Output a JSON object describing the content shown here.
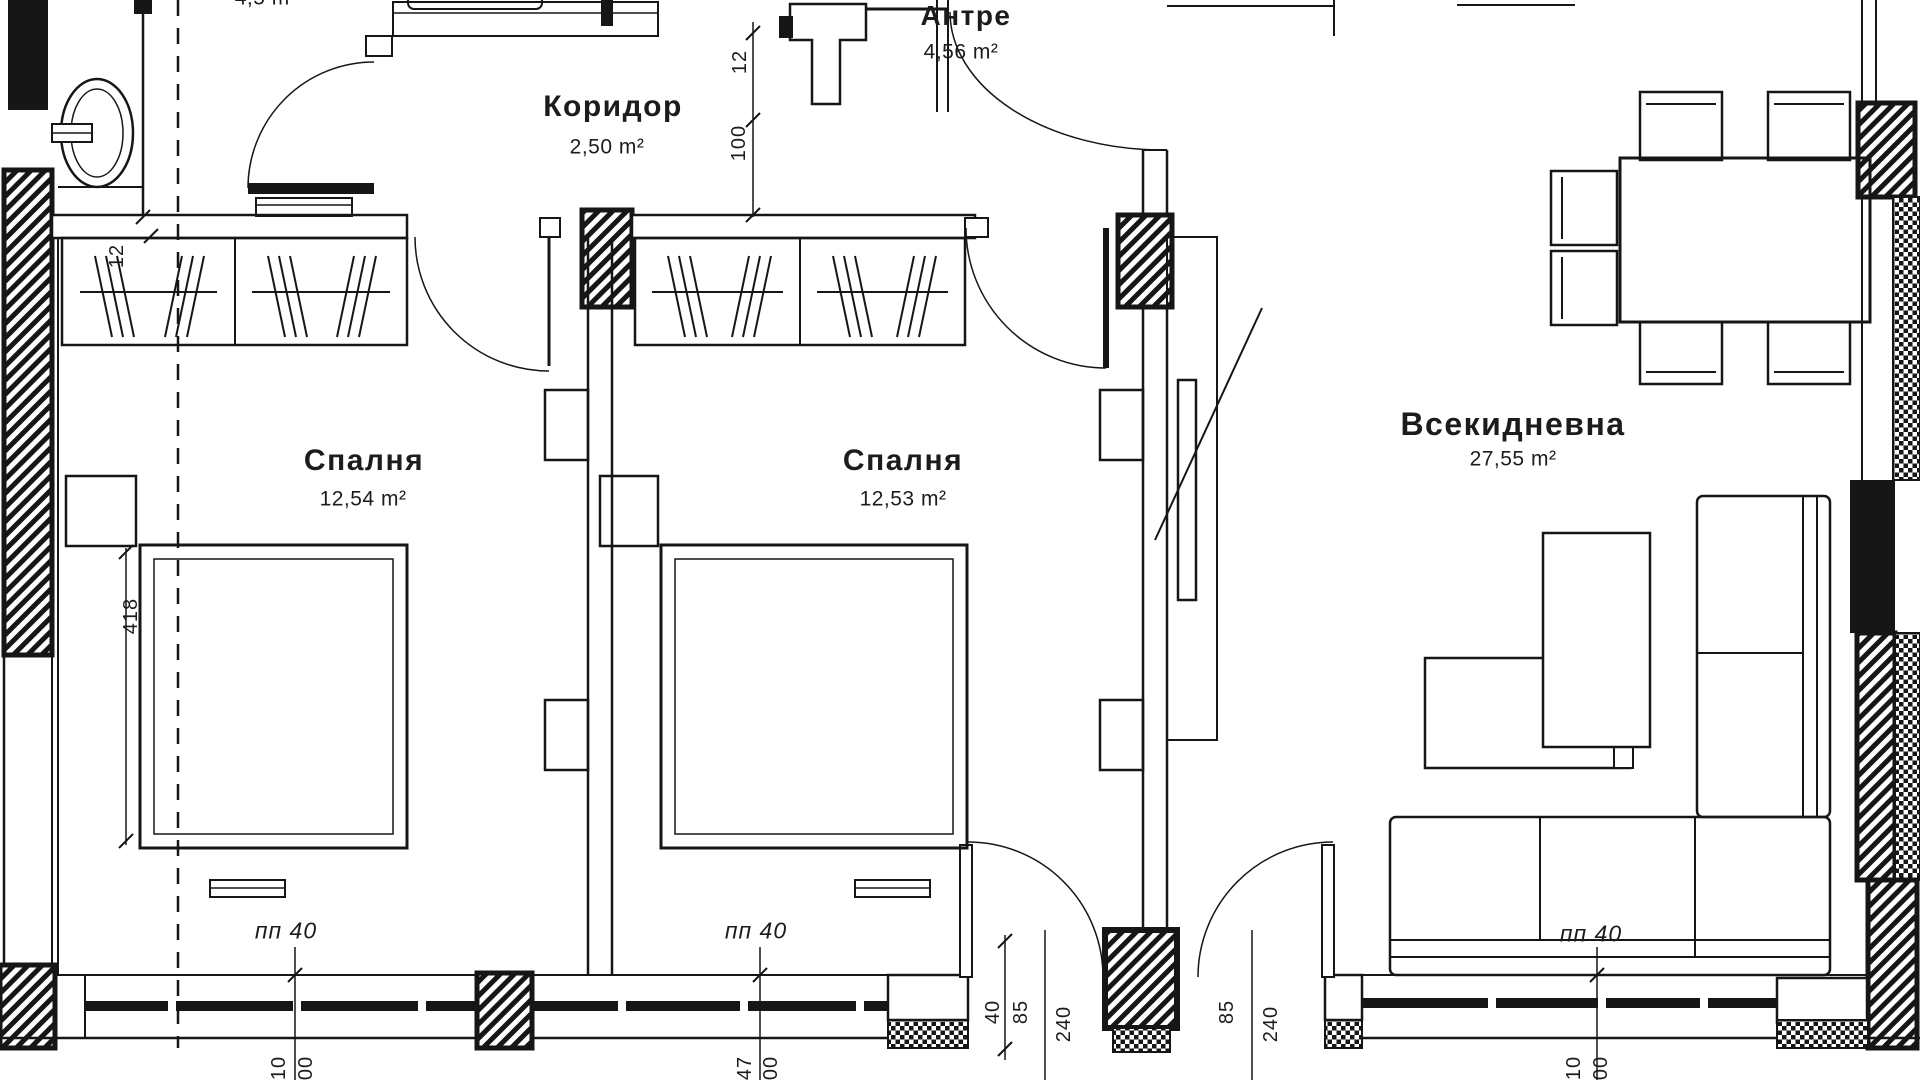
{
  "plan_title": "Apartment floor plan",
  "rooms": [
    {
      "name": "Коридор",
      "area": "2,50 m²"
    },
    {
      "name": "Антре",
      "area": "4,56 m²"
    },
    {
      "name": "Спалня",
      "area": "12,54 m²"
    },
    {
      "name": "Спалня",
      "area": "12,53 m²"
    },
    {
      "name": "Всекидневна",
      "area": "27,55 m²"
    }
  ],
  "partial_top_label": "4,5 m²",
  "parapet": [
    "пп 40",
    "пп 40",
    "пп 40"
  ],
  "dimensions": {
    "corridor_width": "12",
    "corridor_length": "100",
    "wall_thickness": "12",
    "room_depth": "418",
    "door_clear": "40",
    "parapet_left": "85",
    "opening_left": "240",
    "parapet_right": "85",
    "opening_right": "240",
    "cut": [
      "10",
      "00",
      "47",
      "00",
      "10",
      "00"
    ]
  },
  "colors": {
    "line": "#161616",
    "background": "#ffffff"
  }
}
